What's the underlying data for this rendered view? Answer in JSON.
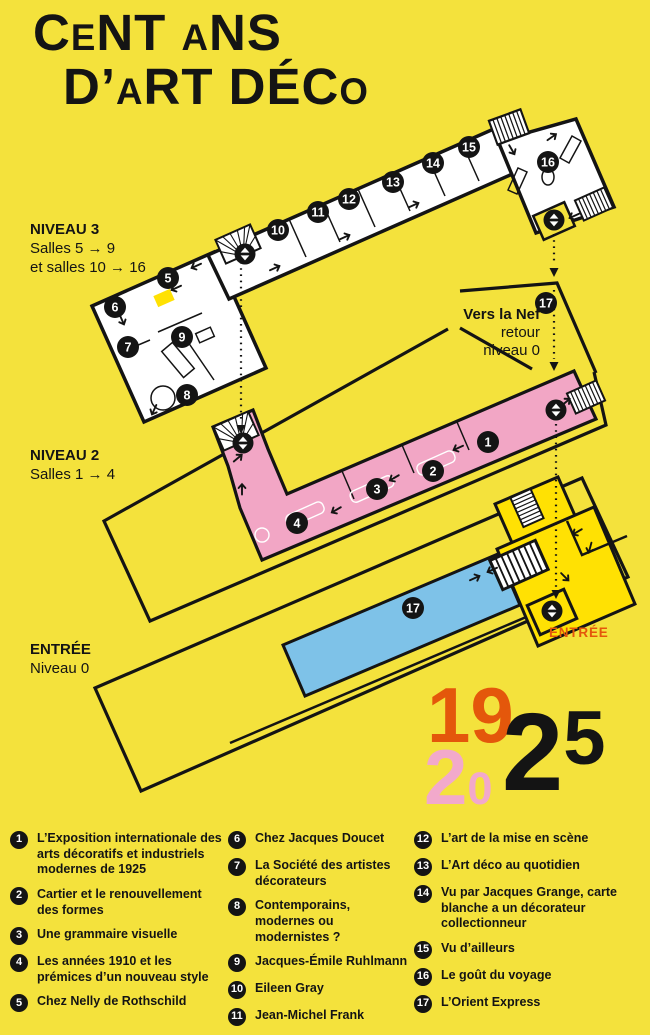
{
  "title": {
    "line1": [
      {
        "t": "C"
      },
      {
        "t": "E",
        "small": true
      },
      {
        "t": "NT "
      },
      {
        "t": "A",
        "small": true
      },
      {
        "t": "NS"
      }
    ],
    "line2": [
      {
        "t": "D’"
      },
      {
        "t": "A",
        "small": true
      },
      {
        "t": "RT DÉC"
      },
      {
        "t": "O",
        "small": true
      }
    ]
  },
  "levels": {
    "n3": {
      "title": "NIVEAU 3",
      "lines": [
        "Salles 5 → 9",
        "et salles 10 → 16"
      ]
    },
    "n2": {
      "title": "NIVEAU 2",
      "lines": [
        "Salles 1 → 4"
      ]
    },
    "n0": {
      "title": "ENTRÉE",
      "lines": [
        "Niveau 0"
      ]
    }
  },
  "nef": {
    "bold": "Vers la Nef",
    "line2": "retour",
    "line3": "niveau 0"
  },
  "entrance_label": "ENTRÉE",
  "year": {
    "top": "19",
    "mid2": "2",
    "mid0": "0",
    "big2": "2",
    "big5": "5"
  },
  "badges": {
    "b1": "1",
    "b2": "2",
    "b3": "3",
    "b4": "4",
    "b5": "5",
    "b6": "6",
    "b7": "7",
    "b8": "8",
    "b9": "9",
    "b10": "10",
    "b11": "11",
    "b12": "12",
    "b13": "13",
    "b14": "14",
    "b15": "15",
    "b16": "16",
    "b17": "17"
  },
  "legend": {
    "items": [
      {
        "num": "1",
        "text": "L’Exposition internationale des arts décoratifs et industriels modernes de 1925"
      },
      {
        "num": "2",
        "text": "Cartier et le renouvellement des formes"
      },
      {
        "num": "3",
        "text": "Une grammaire visuelle"
      },
      {
        "num": "4",
        "text": "Les années 1910 et les prémices d’un nouveau style"
      },
      {
        "num": "5",
        "text": "Chez Nelly de Rothschild"
      },
      {
        "num": "6",
        "text": "Chez Jacques Doucet"
      },
      {
        "num": "7",
        "text": "La Société des artistes décorateurs"
      },
      {
        "num": "8",
        "text": "Contemporains, modernes ou modernistes ?"
      },
      {
        "num": "9",
        "text": "Jacques-Émile Ruhlmann"
      },
      {
        "num": "10",
        "text": "Eileen Gray"
      },
      {
        "num": "11",
        "text": "Jean-Michel Frank"
      },
      {
        "num": "12",
        "text": "L’art de la mise en scène"
      },
      {
        "num": "13",
        "text": "L’Art déco au quotidien"
      },
      {
        "num": "14",
        "text": "Vu par Jacques Grange, carte blanche a un décorateur collectionneur"
      },
      {
        "num": "15",
        "text": "Vu d’ailleurs"
      },
      {
        "num": "16",
        "text": "Le goût du voyage"
      },
      {
        "num": "17",
        "text": "L’Orient Express"
      }
    ]
  },
  "colors": {
    "background": "#F4E23C",
    "pink": "#F2A6C5",
    "blue": "#7EC2E8",
    "bright_yellow": "#FFE103",
    "orange": "#E4570B",
    "year_pink": "#F2A9CB",
    "black": "#141414",
    "white": "#FFFFFF"
  }
}
